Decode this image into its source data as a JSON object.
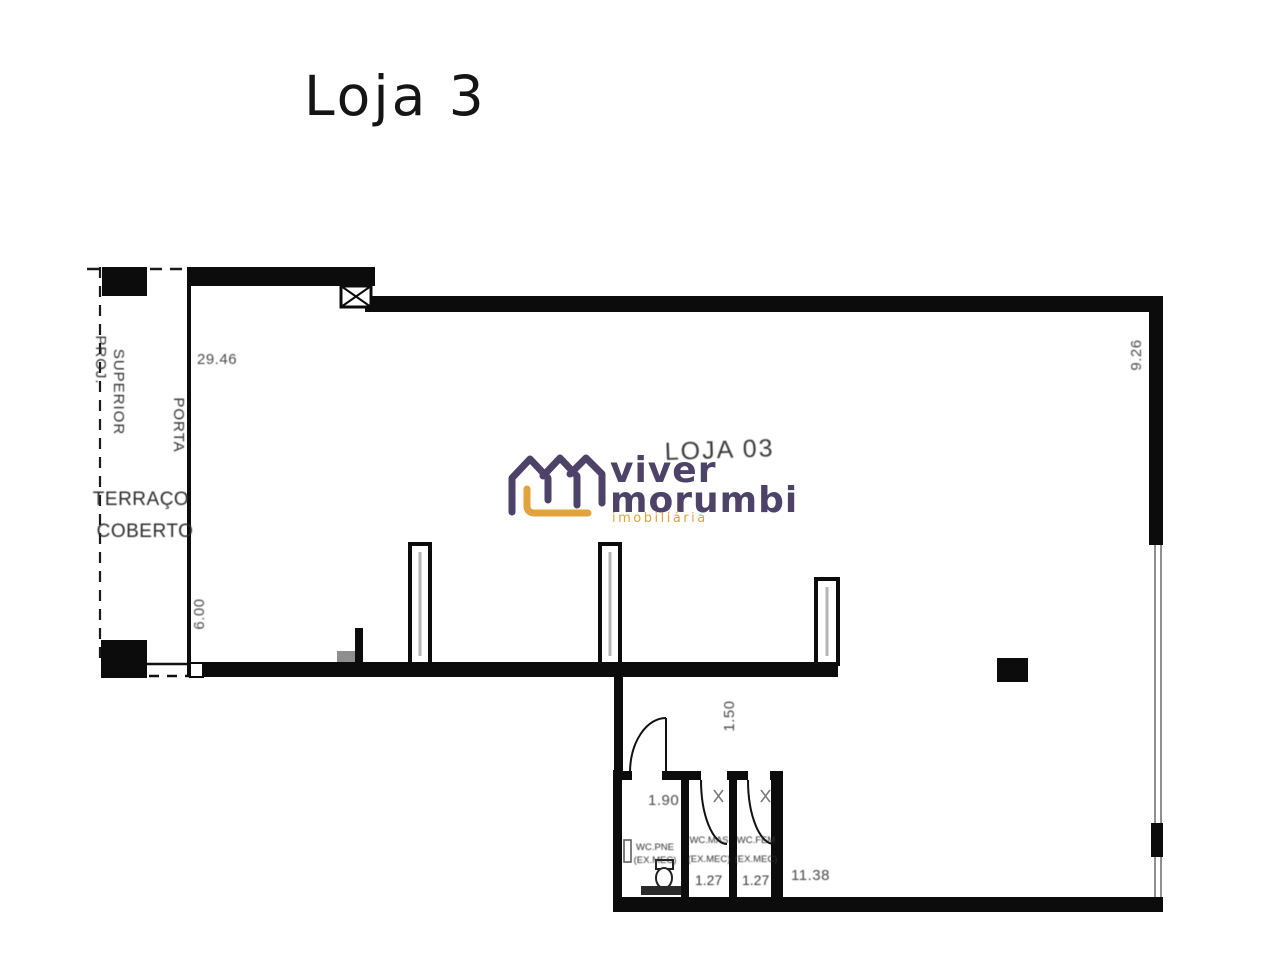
{
  "title": "Loja 3",
  "watermark": {
    "brand_line1": "viver",
    "brand_line2": "morumbi",
    "tagline": "imobiliária",
    "purple": "#4d4368",
    "orange": "#e2a23e"
  },
  "plan": {
    "room_label": "LOJA 03",
    "wall_color": "#0c0c0c",
    "label_color": "#3f3f3f",
    "left_labels": {
      "proj": "PROJ.",
      "superior": "SUPERIOR",
      "porta": "PORTA",
      "terraco": "TERRAÇO",
      "coberto": "COBERTO"
    },
    "dims": {
      "top": "29.46",
      "right": "9.26",
      "terrace": "6.00",
      "corridor": "1.50",
      "wc_pne": "1.90",
      "wc_mas": "1.27",
      "wc_fem": "1.27",
      "bottom": "11.38"
    },
    "wc": {
      "pne": "WC.PNE",
      "pne_sub": "(EX.MEC)",
      "mas": "WC.MAS",
      "mas_sub": "(EX.MEC)",
      "fem": "WC.FEM",
      "fem_sub": "(EX.MEC)"
    }
  }
}
